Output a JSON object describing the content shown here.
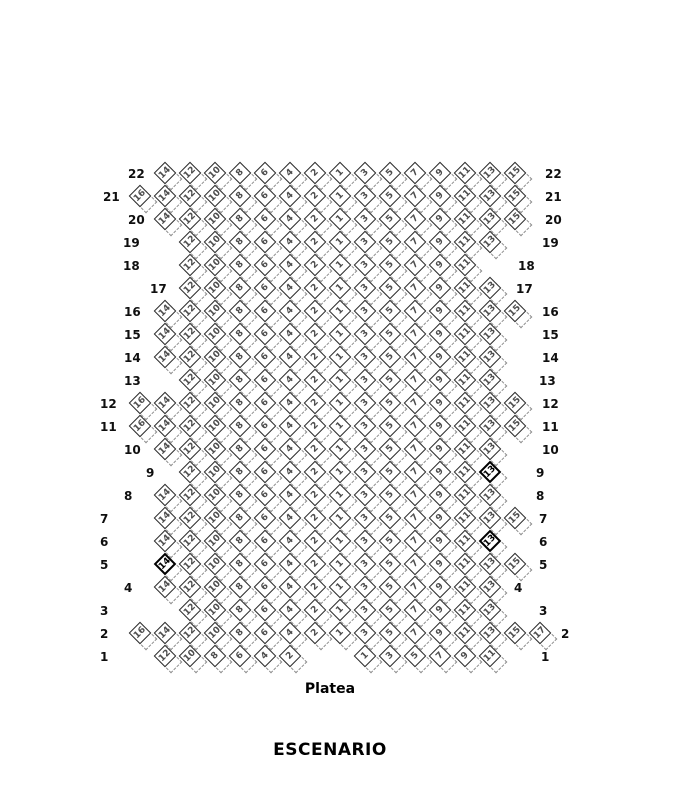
{
  "labels": {
    "area": "Platea",
    "stage": "ESCENARIO"
  },
  "colors": {
    "seat_border": "#2b2b2b",
    "seat_number": "#4d4d4d",
    "dark_seat": "#000000",
    "shadow_dash": "#8f8f8f",
    "background": "#ffffff"
  },
  "seat_map": {
    "rows": [
      {
        "row": 22,
        "lx": 128,
        "rx": 545,
        "seats": [
          14,
          12,
          10,
          8,
          6,
          4,
          2,
          1,
          3,
          5,
          7,
          9,
          11,
          13,
          15
        ]
      },
      {
        "row": 21,
        "lx": 103,
        "rx": 545,
        "seats": [
          16,
          14,
          12,
          10,
          8,
          6,
          4,
          2,
          1,
          3,
          5,
          7,
          9,
          11,
          13,
          15
        ]
      },
      {
        "row": 20,
        "lx": 128,
        "rx": 545,
        "seats": [
          14,
          12,
          10,
          8,
          6,
          4,
          2,
          1,
          3,
          5,
          7,
          9,
          11,
          13,
          15
        ]
      },
      {
        "row": 19,
        "lx": 123,
        "rx": 542,
        "seats": [
          12,
          10,
          8,
          6,
          4,
          2,
          1,
          3,
          5,
          7,
          9,
          11,
          13
        ]
      },
      {
        "row": 18,
        "lx": 123,
        "rx": 518,
        "seats": [
          12,
          10,
          8,
          6,
          4,
          2,
          1,
          3,
          5,
          7,
          9,
          11
        ]
      },
      {
        "row": 17,
        "lx": 150,
        "rx": 516,
        "seats": [
          12,
          10,
          8,
          6,
          4,
          2,
          1,
          3,
          5,
          7,
          9,
          11,
          13
        ]
      },
      {
        "row": 16,
        "lx": 124,
        "rx": 542,
        "seats": [
          14,
          12,
          10,
          8,
          6,
          4,
          2,
          1,
          3,
          5,
          7,
          9,
          11,
          13,
          15
        ]
      },
      {
        "row": 15,
        "lx": 124,
        "rx": 542,
        "seats": [
          14,
          12,
          10,
          8,
          6,
          4,
          2,
          1,
          3,
          5,
          7,
          9,
          11,
          13
        ]
      },
      {
        "row": 14,
        "lx": 124,
        "rx": 542,
        "seats": [
          14,
          12,
          10,
          8,
          6,
          4,
          2,
          1,
          3,
          5,
          7,
          9,
          11,
          13
        ]
      },
      {
        "row": 13,
        "lx": 124,
        "rx": 539,
        "seats": [
          12,
          10,
          8,
          6,
          4,
          2,
          1,
          3,
          5,
          7,
          9,
          11,
          13
        ]
      },
      {
        "row": 12,
        "lx": 100,
        "rx": 542,
        "seats": [
          16,
          14,
          12,
          10,
          8,
          6,
          4,
          2,
          1,
          3,
          5,
          7,
          9,
          11,
          13,
          15
        ]
      },
      {
        "row": 11,
        "lx": 100,
        "rx": 542,
        "seats": [
          16,
          14,
          12,
          10,
          8,
          6,
          4,
          2,
          1,
          3,
          5,
          7,
          9,
          11,
          13,
          15
        ]
      },
      {
        "row": 10,
        "lx": 124,
        "rx": 542,
        "seats": [
          14,
          12,
          10,
          8,
          6,
          4,
          2,
          1,
          3,
          5,
          7,
          9,
          11,
          13
        ]
      },
      {
        "row": 9,
        "lx": 146,
        "rx": 536,
        "seats": [
          12,
          10,
          8,
          6,
          4,
          2,
          1,
          3,
          5,
          7,
          9,
          11,
          13
        ]
      },
      {
        "row": 8,
        "lx": 124,
        "rx": 536,
        "seats": [
          14,
          12,
          10,
          8,
          6,
          4,
          2,
          1,
          3,
          5,
          7,
          9,
          11,
          13
        ]
      },
      {
        "row": 7,
        "lx": 100,
        "rx": 539,
        "seats": [
          14,
          12,
          10,
          8,
          6,
          4,
          2,
          1,
          3,
          5,
          7,
          9,
          11,
          13,
          15
        ]
      },
      {
        "row": 6,
        "lx": 100,
        "rx": 539,
        "seats": [
          14,
          12,
          10,
          8,
          6,
          4,
          2,
          1,
          3,
          5,
          7,
          9,
          11,
          13
        ]
      },
      {
        "row": 5,
        "lx": 100,
        "rx": 539,
        "seats": [
          14,
          12,
          10,
          8,
          6,
          4,
          2,
          1,
          3,
          5,
          7,
          9,
          11,
          13,
          15
        ]
      },
      {
        "row": 4,
        "lx": 124,
        "rx": 514,
        "seats": [
          14,
          12,
          10,
          8,
          6,
          4,
          2,
          1,
          3,
          5,
          7,
          9,
          11,
          13
        ]
      },
      {
        "row": 3,
        "lx": 100,
        "rx": 539,
        "seats": [
          12,
          10,
          8,
          6,
          4,
          2,
          1,
          3,
          5,
          7,
          9,
          11,
          13
        ]
      },
      {
        "row": 2,
        "lx": 100,
        "rx": 561,
        "seats": [
          16,
          14,
          12,
          10,
          8,
          6,
          4,
          2,
          1,
          3,
          5,
          7,
          9,
          11,
          13,
          15,
          17
        ]
      },
      {
        "row": 1,
        "lx": 100,
        "rx": 541,
        "shift_out": true,
        "seats": [
          12,
          10,
          8,
          6,
          4,
          2,
          1,
          3,
          5,
          7,
          9,
          11
        ]
      }
    ],
    "dark_seats": [
      {
        "row": 9,
        "seat": 13
      },
      {
        "row": 6,
        "seat": 13
      },
      {
        "row": 5,
        "seat": 14
      }
    ]
  }
}
